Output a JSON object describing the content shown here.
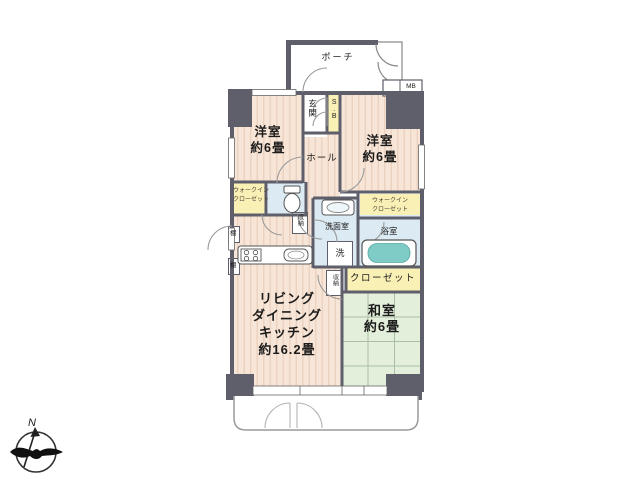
{
  "plan": {
    "porch": {
      "label": "ポーチ"
    },
    "meter_box": {
      "label": "MB"
    },
    "entrance": {
      "label": "玄関"
    },
    "shoe_box": {
      "label": "S.B"
    },
    "western_room_left": {
      "name": "洋室",
      "size": "約6畳"
    },
    "western_room_right": {
      "name": "洋室",
      "size": "約6畳"
    },
    "hall": {
      "label": "ホール"
    },
    "walk_in_closet_left": {
      "line1": "ウォークイン",
      "line2": "クローゼット"
    },
    "walk_in_closet_right": {
      "line1": "ウォークイン",
      "line2": "クローゼット"
    },
    "washroom": {
      "label": "洗面室"
    },
    "bathroom": {
      "label": "浴室"
    },
    "washer": {
      "label": "洗"
    },
    "closet": {
      "label": "クローゼット"
    },
    "storage_hall": {
      "label": "収納"
    },
    "storage_ldk": {
      "label": "収納"
    },
    "ldk": {
      "line1": "リビング",
      "line2": "ダイニング",
      "line3": "キッチン",
      "line4": "約16.2畳"
    },
    "japanese_room": {
      "name": "和室",
      "size": "約6畳"
    },
    "shelf_upper": {
      "label": "棚"
    },
    "shelf_lower": {
      "label": "棚"
    },
    "compass": {
      "north": "N"
    },
    "colors": {
      "flooring": "#f7e6d7",
      "flooring_stripe": "#ecd2c0",
      "tatami": "#e4efdb",
      "tatami_line": "#a9bfa5",
      "closet_yellow": "#f9f0b6",
      "water_area_blue": "#dcebf3",
      "bathtub_teal": "#7fccc6",
      "wall_gray": "#5e5f6a"
    }
  }
}
